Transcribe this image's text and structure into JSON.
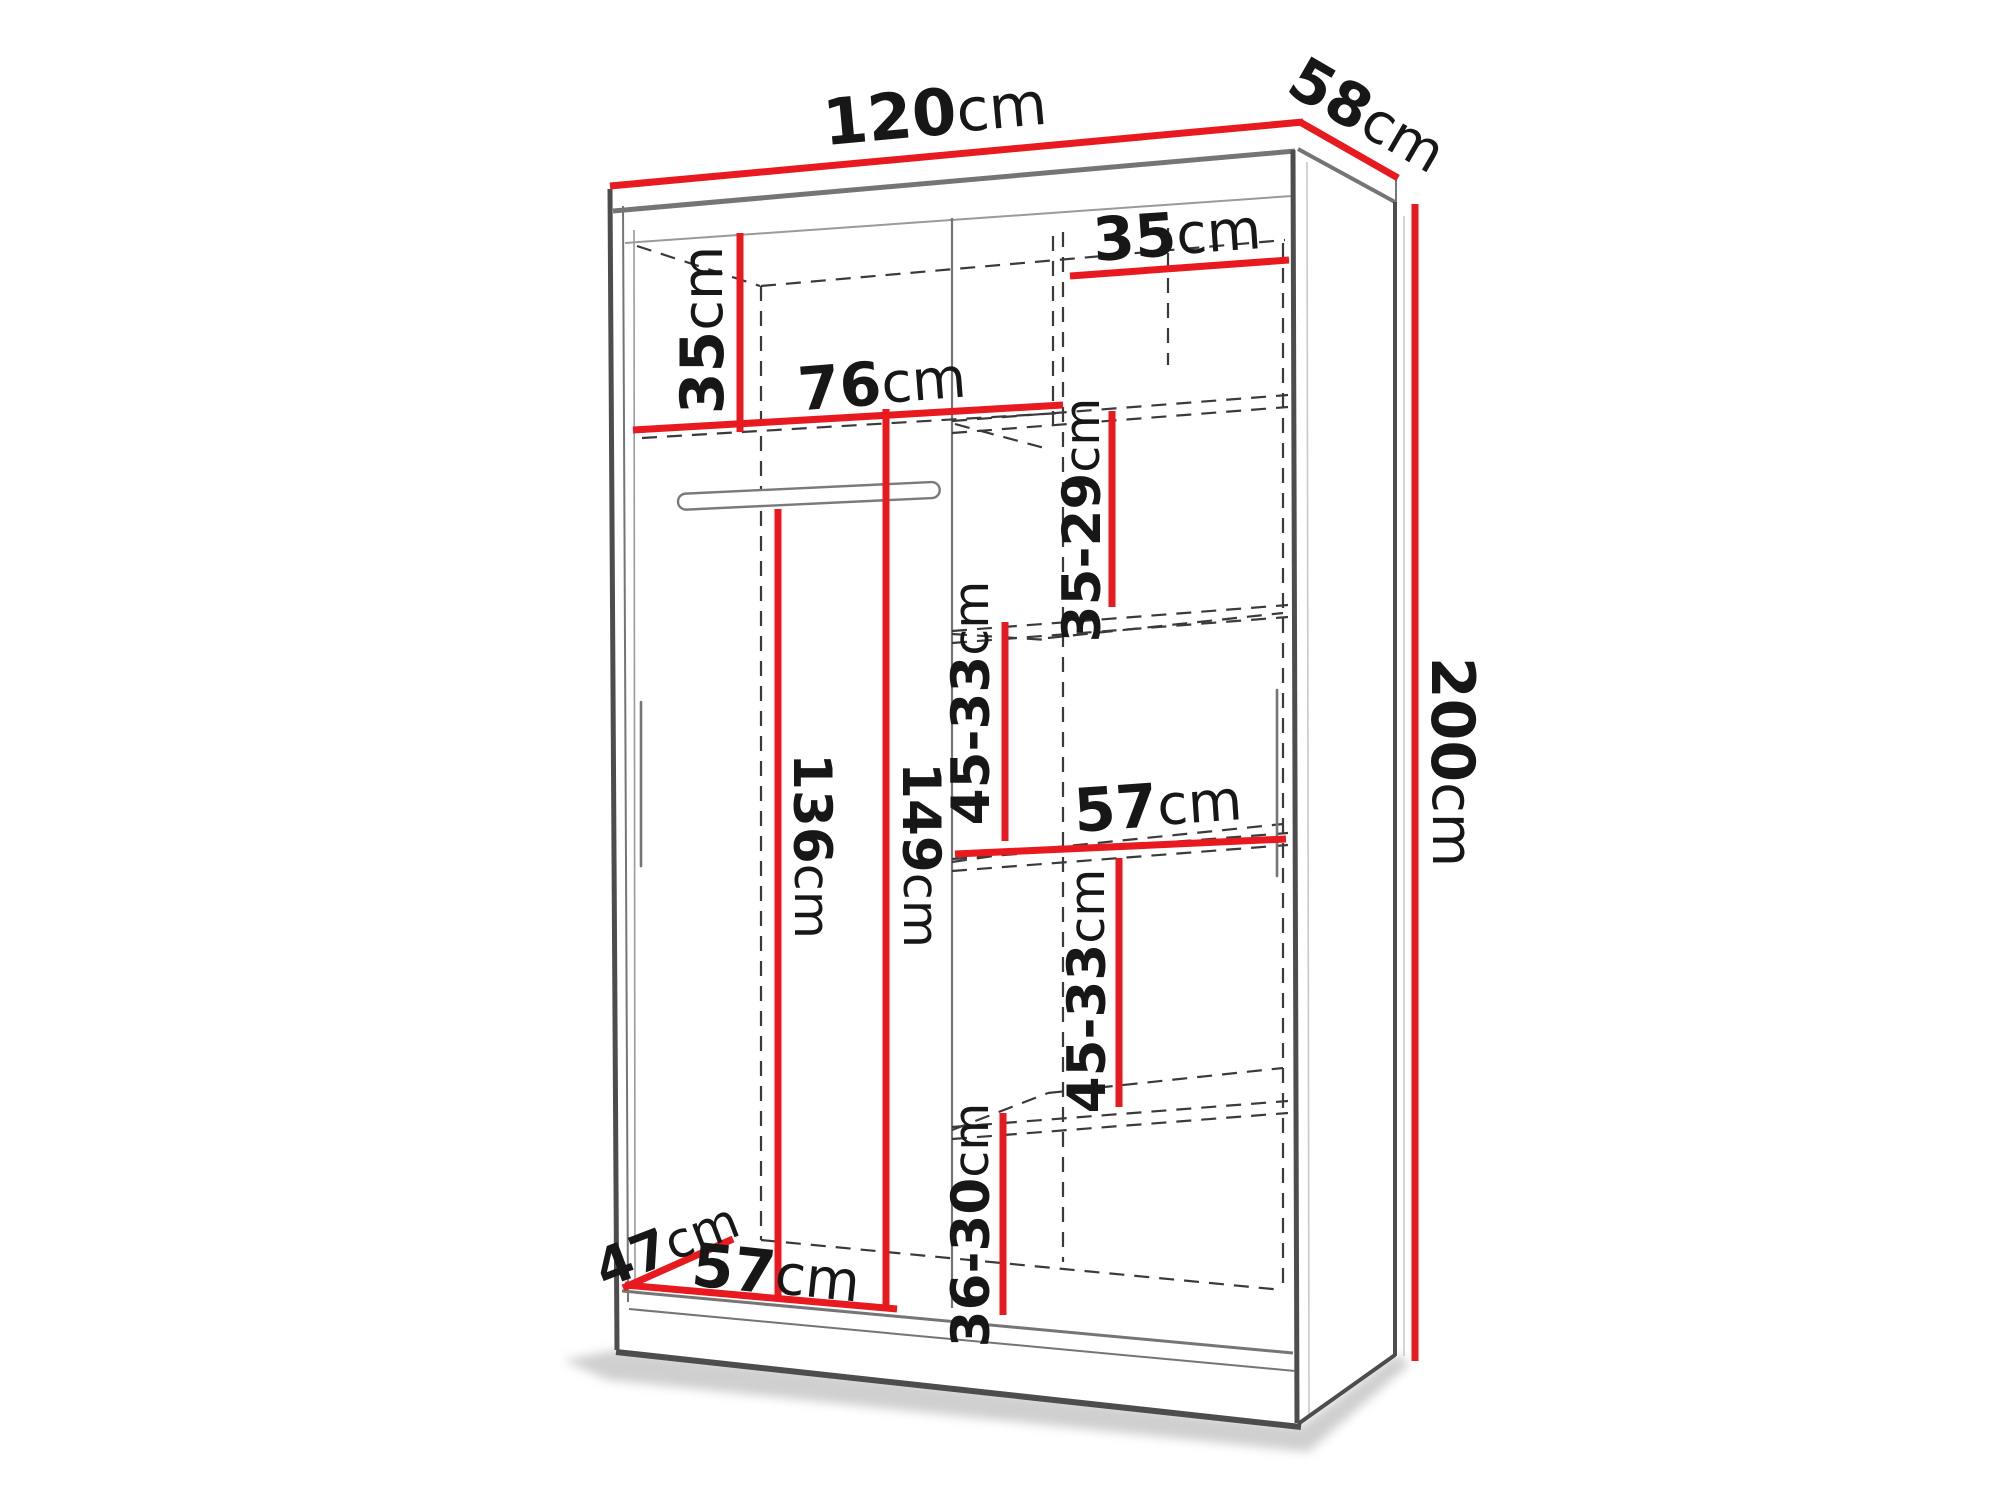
{
  "diagram_title": "wardrobe-dimension-drawing",
  "colors": {
    "accent": "#e8191f",
    "outline_dark": "#4d4d4d",
    "outline_mid": "#757575",
    "dash": "#3a3a3a",
    "text": "#171717",
    "background": "#ffffff"
  },
  "dimensions": {
    "top_width": {
      "value": "120",
      "unit": "cm"
    },
    "top_depth": {
      "value": "58",
      "unit": "cm"
    },
    "total_height": {
      "value": "200",
      "unit": "cm"
    },
    "left_top_height": {
      "value": "35",
      "unit": "cm"
    },
    "left_width": {
      "value": "76",
      "unit": "cm"
    },
    "right_top_height": {
      "value": "35",
      "unit": "cm"
    },
    "shelf_gap_upper": {
      "value": "35-29",
      "unit": "cm"
    },
    "shelf_gap_middle": {
      "value": "45-33",
      "unit": "cm"
    },
    "right_width": {
      "value": "57",
      "unit": "cm"
    },
    "shelf_gap_lower": {
      "value": "45-33",
      "unit": "cm"
    },
    "bottom_gap": {
      "value": "36-30",
      "unit": "cm"
    },
    "hanging_height": {
      "value": "136",
      "unit": "cm"
    },
    "left_section_height": {
      "value": "149",
      "unit": "cm"
    },
    "floor_depth": {
      "value": "47",
      "unit": "cm"
    },
    "bottom_width": {
      "value": "57",
      "unit": "cm"
    }
  }
}
